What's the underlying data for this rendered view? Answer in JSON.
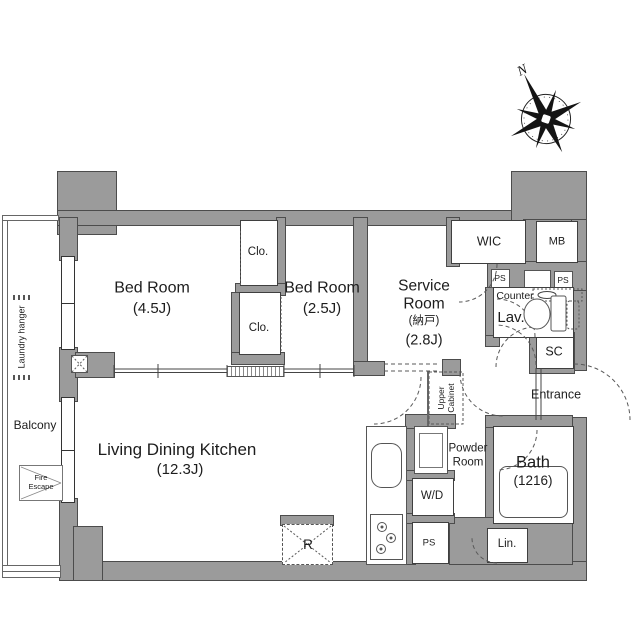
{
  "compass": {
    "north": "N"
  },
  "rooms": {
    "bedroom1": {
      "name": "Bed Room",
      "size": "(4.5J)"
    },
    "bedroom2": {
      "name": "Bed Room",
      "size": "(2.5J)"
    },
    "service": {
      "name": "Service Room",
      "alt": "(納戸)",
      "size": "(2.8J)"
    },
    "ldk": {
      "name": "Living Dining Kitchen",
      "size": "(12.3J)"
    },
    "bath": {
      "name": "Bath",
      "size": "(1216)"
    }
  },
  "labels": {
    "wic": "WIC",
    "mb": "MB",
    "clo_top": "Clo.",
    "clo_bottom": "Clo.",
    "ps_top_left": "PS",
    "ps_top_right": "PS",
    "ps_bottom": "PS",
    "counter": "Counter",
    "lav": "Lav.",
    "sc": "SC",
    "entrance": "Entrance",
    "powder_room": "Powder Room",
    "upper_cabinet": "Upper Cabinet",
    "washer_dryer": "W/D",
    "linen": "Lin.",
    "refrigerator": "R",
    "balcony": "Balcony",
    "fire_escape": "Fire Escape",
    "laundry_hanger": "Laundry hanger"
  },
  "colors": {
    "wall": "#9b9b9b",
    "outline": "#4c4c4c",
    "line": "#555555",
    "text": "#1d1d1d"
  }
}
